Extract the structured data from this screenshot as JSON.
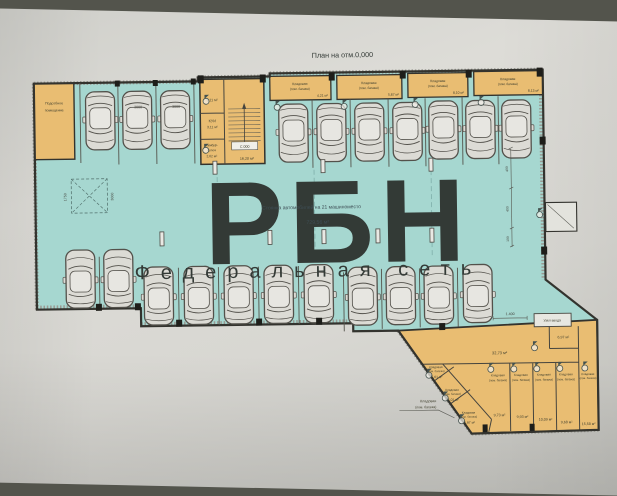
{
  "photo": {
    "surface_color": "#53544c",
    "paper_color": "#d8d8d3"
  },
  "title": "План на отм.0,000",
  "watermark": {
    "text": "РБН",
    "subtitle": "Федеральная сеть",
    "color": "#d95f6e"
  },
  "plan": {
    "floor_color": "#a6d7d0",
    "room_color": "#e9bd72",
    "parking_note": "Стоянка автомобилей на 21 машиноместо",
    "parking_area": "729,56 м²",
    "parking_spaces": 21,
    "labels": {
      "storage_l1": "Кладовая",
      "storage_l2": "(пом. багажа)",
      "utility_l1": "Подсобное",
      "utility_l2": "помещение",
      "kui": "КУИ",
      "tambur_l1": "Тамбур-",
      "tambur_l2": "шлюз",
      "entry_node": "Узел ввода",
      "level_mark": "С.000"
    },
    "areas": {
      "stair_cell": "3,11 м²",
      "kui": "3,11 м²",
      "tambur": "2,62 м²",
      "stairwell": "16,20 м²",
      "corridor": "32,73 м²",
      "ne_room": "6,97 м²",
      "top_storage": [
        "4,21 м²",
        "5,87 м²",
        "8,10 м²",
        "8,13 м²"
      ],
      "diag_storage": [
        "5,61 м²",
        "5,01 м²",
        "5,97 м²"
      ],
      "row_storage": [
        "9,73 м²",
        "9,93 м²",
        "10,09 м²",
        "9,68 м²",
        "15,58 м²"
      ]
    },
    "dims": {
      "spot_width": "3000",
      "turn_w": "1750",
      "d1400": "1.400",
      "d400": "400",
      "d100": "100"
    }
  }
}
